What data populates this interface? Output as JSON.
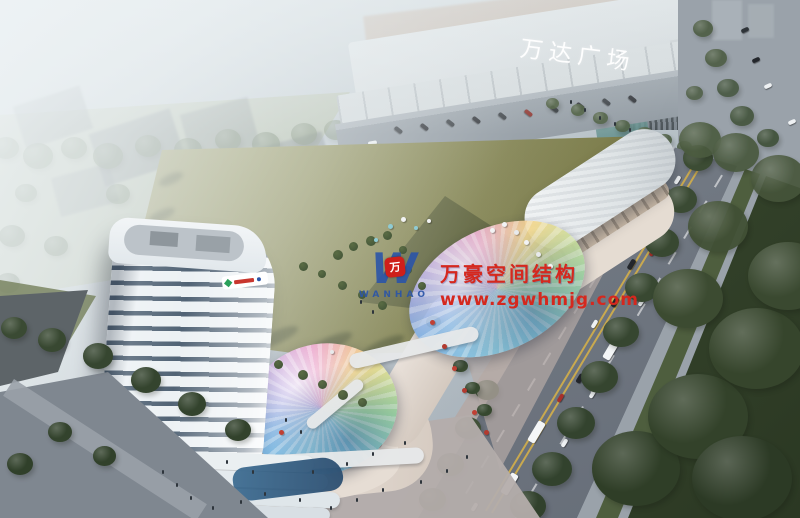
{
  "scene": {
    "description": "Aerial dusk rendering of a mixed-use commercial complex: high-rise tower, curved retail podium with two iridescent membrane canopies, central lawn, Wanda Plaza mall and tree-lined avenue",
    "mall_sign": "万达广场"
  },
  "watermark": {
    "logo_letter": "W",
    "logo_badge": "万",
    "logo_name": "WANHAO",
    "line1": "万豪空间结构",
    "line2": "www.zgwhmjg.com"
  },
  "palette": {
    "watermark_red": "#d5281e",
    "watermark_blue": "#2b55a8",
    "lawn_olive": "#82824d",
    "dark_foliage": "#36462f",
    "road_gray": "#79818b",
    "fog_white": "#eef3f5",
    "canopy_rainbow": [
      "#8fd2e6",
      "#7cb0e2",
      "#a98fd8",
      "#e68fc0",
      "#f2d88e",
      "#a5dea6"
    ]
  }
}
